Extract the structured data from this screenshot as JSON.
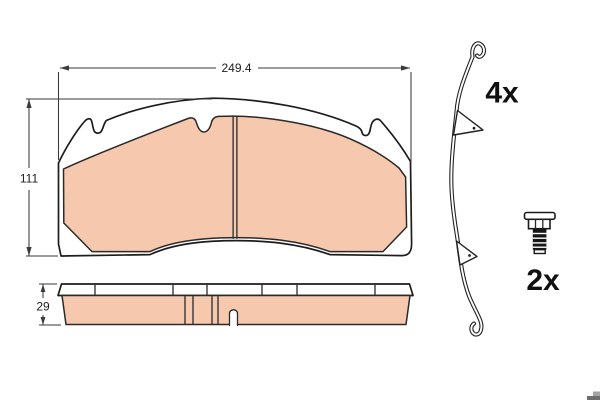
{
  "drawing": {
    "type": "brake-pad-set-technical-drawing",
    "front_view": {
      "width_dim_label": "249.4",
      "height_dim_label": "111"
    },
    "side_view": {
      "thickness_dim_label": "29"
    },
    "accessories": {
      "spring_clip_quantity": "4x",
      "bolt_quantity": "2x"
    },
    "colors": {
      "friction_material": "#f6c9ae",
      "outline": "#1d1d1d",
      "dimension_lines": "#3a3a3a",
      "background": "#ffffff",
      "logo_fragment_gray": "#8a8a8a"
    }
  }
}
